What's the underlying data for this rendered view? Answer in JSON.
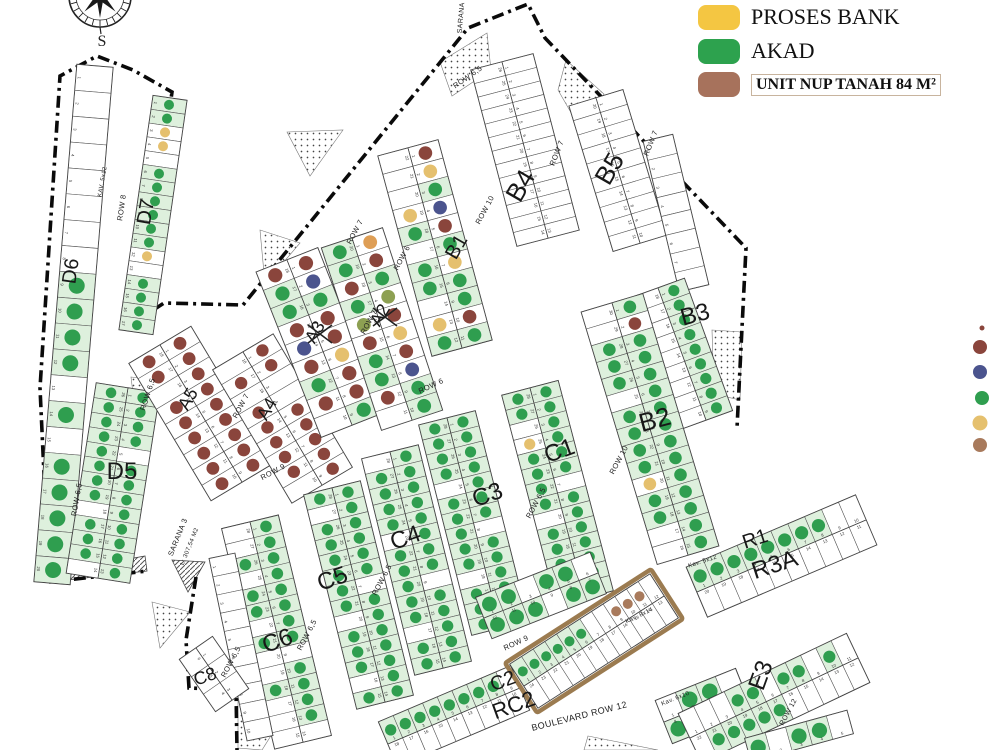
{
  "legend": {
    "items": [
      {
        "label": "PROSES BANK",
        "color": "#f4c642"
      },
      {
        "label": "AKAD",
        "color": "#2da24e"
      },
      {
        "label": "UNIT NUP TANAH 84 M²",
        "color": "#a7725c"
      }
    ]
  },
  "compass": {
    "label": "S"
  },
  "palette": {
    "G": "#2f9e4f",
    "M": "#8a453c",
    "Y": "#e5c06e",
    "N": "#4b548e",
    "B": "#a87a5c",
    "O": "#de9e55",
    "L": "#8da052",
    "tint": "#def0dd",
    "line": "#555555",
    "boundary": "#0a0a0a",
    "nup_outline": "#9b7b50"
  },
  "side_dots": [
    {
      "x": 982,
      "y": 328,
      "r": 2.5,
      "c": "M"
    },
    {
      "x": 980,
      "y": 347,
      "r": 7.0,
      "c": "M"
    },
    {
      "x": 980,
      "y": 372,
      "r": 7.0,
      "c": "N"
    },
    {
      "x": 982,
      "y": 398,
      "r": 7.0,
      "c": "G"
    },
    {
      "x": 980,
      "y": 423,
      "r": 7.5,
      "c": "Y"
    },
    {
      "x": 980,
      "y": 445,
      "r": 7.0,
      "c": "B"
    }
  ],
  "plan": {
    "blocks": [
      {
        "name": "D6",
        "x1": 95,
        "y1": 66,
        "x2": 52,
        "y2": 583,
        "w": 36,
        "rows": 1,
        "n": 20,
        "dots": [
          "--------GGGG-G-GGGGG"
        ]
      },
      {
        "name": "D7",
        "x1": 170,
        "y1": 98,
        "x2": 136,
        "y2": 332,
        "w": 34,
        "rows": 1,
        "n": 17,
        "dots": [
          "GGYY-GGGGGGY-GGGG"
        ]
      },
      {
        "name": "D5",
        "x1": 128,
        "y1": 388,
        "x2": 98,
        "y2": 578,
        "w": 64,
        "rows": 2,
        "n": 13,
        "dots": [
          "GGGG-GGGGGGGG",
          "GGGGGGGG-GGG-"
        ]
      },
      {
        "name": "A5",
        "x1": 160,
        "y1": 345,
        "x2": 242,
        "y2": 482,
        "w": 72,
        "rows": 2,
        "n": 9,
        "dots": [
          "MMMMMMMMM",
          "MM-MMMMMM"
        ]
      },
      {
        "name": "A4",
        "x1": 243,
        "y1": 352,
        "x2": 322,
        "y2": 485,
        "w": 70,
        "rows": 2,
        "n": 9,
        "dots": [
          "MM--MMMMM",
          "-M-MMMMM-"
        ]
      },
      {
        "name": "A3",
        "x1": 287,
        "y1": 260,
        "x2": 352,
        "y2": 425,
        "w": 66,
        "rows": 2,
        "n": 9,
        "dots": [
          "MNGMMYMMG",
          "MGGMNMGM-"
        ]
      },
      {
        "name": "A2",
        "x1": 352,
        "y1": 238,
        "x2": 412,
        "y2": 420,
        "w": 64,
        "rows": 2,
        "n": 10,
        "dots": [
          "OMGLMYMNGG",
          "GGMGLMGGM-"
        ]
      },
      {
        "name": "B1",
        "x1": 408,
        "y1": 148,
        "x2": 462,
        "y2": 348,
        "w": 62,
        "rows": 2,
        "n": 11,
        "dots": [
          "MYGNMGYGGMG",
          "---YG-GG-YG"
        ]
      },
      {
        "name": "B4",
        "x1": 502,
        "y1": 62,
        "x2": 548,
        "y2": 238,
        "w": 64,
        "rows": 2,
        "n": 13,
        "dots": [
          "-------------",
          "-------------"
        ]
      },
      {
        "name": "B5",
        "x1": 596,
        "y1": 98,
        "x2": 640,
        "y2": 243,
        "w": 56,
        "rows": 2,
        "n": 10,
        "dots": [
          "----------",
          "----------"
        ]
      },
      {
        "name": "B5E",
        "x1": 658,
        "y1": 138,
        "x2": 694,
        "y2": 288,
        "w": 30,
        "rows": 1,
        "n": 8,
        "dots": [
          "--------"
        ]
      },
      {
        "name": "B3",
        "x1": 658,
        "y1": 288,
        "x2": 706,
        "y2": 420,
        "w": 56,
        "rows": 2,
        "n": 9,
        "dots": [
          "GGGGGGGGG",
          "---------"
        ]
      },
      {
        "name": "B2",
        "x1": 612,
        "y1": 303,
        "x2": 688,
        "y2": 555,
        "w": 64,
        "rows": 2,
        "n": 15,
        "dots": [
          "GMGGGGGGGGGGGGG",
          "--GGG-GGGGYGG--"
        ]
      },
      {
        "name": "C1",
        "x1": 530,
        "y1": 388,
        "x2": 585,
        "y2": 598,
        "w": 58,
        "rows": 2,
        "n": 14,
        "dots": [
          "GGGGGG-GGGGGGG",
          "GG-YGGGG-GGGGG"
        ]
      },
      {
        "name": "C3",
        "x1": 447,
        "y1": 418,
        "x2": 500,
        "y2": 628,
        "w": 58,
        "rows": 2,
        "n": 14,
        "dots": [
          "GGGGGGG-GGGGGG",
          "GGGG-GGGGG-GGG"
        ]
      },
      {
        "name": "C4",
        "x1": 390,
        "y1": 452,
        "x2": 443,
        "y2": 668,
        "w": 58,
        "rows": 2,
        "n": 14,
        "dots": [
          "GGGGGGGG-GGGGG",
          "-GGGG-GGGGG-GG"
        ]
      },
      {
        "name": "C5",
        "x1": 332,
        "y1": 488,
        "x2": 385,
        "y2": 702,
        "w": 58,
        "rows": 2,
        "n": 14,
        "dots": [
          "GGGGGG-GGGGGGG",
          "G-GGGGGG-GGG-G"
        ]
      },
      {
        "name": "C6",
        "x1": 250,
        "y1": 522,
        "x2": 303,
        "y2": 742,
        "w": 58,
        "rows": 2,
        "n": 14,
        "dots": [
          "GGGGGGGG-GGGG-",
          "--G-GG-G--G---"
        ]
      },
      {
        "name": "C7",
        "x1": 222,
        "y1": 556,
        "x2": 260,
        "y2": 738,
        "w": 26,
        "rows": 1,
        "n": 10,
        "dots": [
          "----------"
        ]
      },
      {
        "name": "C8",
        "x1": 196,
        "y1": 648,
        "x2": 232,
        "y2": 700,
        "w": 40,
        "rows": 2,
        "n": 3,
        "dots": [
          "---",
          "---"
        ]
      },
      {
        "name": "R9M",
        "x1": 484,
        "y1": 618,
        "x2": 598,
        "y2": 573,
        "w": 44,
        "rows": 2,
        "n": 6,
        "dots": [
          "GG-GG-",
          "GGG-GG"
        ]
      },
      {
        "name": "C2S",
        "x1": 388,
        "y1": 744,
        "x2": 520,
        "y2": 688,
        "w": 48,
        "rows": 2,
        "n": 9,
        "dots": [
          "GGGGGGGG-",
          "---------"
        ]
      },
      {
        "name": "RC2N",
        "x1": 524,
        "y1": 686,
        "x2": 664,
        "y2": 596,
        "w": 52,
        "rows": 2,
        "n": 12,
        "dots": [
          "GGGGGG--BBB-",
          "------------"
        ],
        "outline": true
      },
      {
        "name": "K610",
        "x1": 664,
        "y1": 722,
        "x2": 744,
        "y2": 690,
        "w": 46,
        "rows": 2,
        "n": 4,
        "dots": [
          "-GG-",
          "G--G"
        ]
      },
      {
        "name": "E3",
        "x1": 690,
        "y1": 738,
        "x2": 858,
        "y2": 658,
        "w": 54,
        "rows": 2,
        "n": 11,
        "dots": [
          "---GG-GG-G-",
          "-GGGGG-----"
        ]
      },
      {
        "name": "R3A",
        "x1": 697,
        "y1": 592,
        "x2": 866,
        "y2": 520,
        "w": 54,
        "rows": 2,
        "n": 10,
        "dots": [
          "GGGGGGGG--",
          "----------"
        ]
      },
      {
        "name": "E3S",
        "x1": 748,
        "y1": 750,
        "x2": 850,
        "y2": 722,
        "w": 24,
        "rows": 1,
        "n": 5,
        "dots": [
          "G-GG-"
        ]
      }
    ],
    "labels": [
      {
        "t": "D6",
        "x": 77,
        "y": 272,
        "r": -82,
        "s": 20
      },
      {
        "t": "D7",
        "x": 152,
        "y": 213,
        "r": -80,
        "s": 20
      },
      {
        "t": "D5",
        "x": 122,
        "y": 479,
        "r": 0,
        "s": 24
      },
      {
        "t": "A5",
        "x": 193,
        "y": 402,
        "r": -60,
        "s": 18
      },
      {
        "t": "A4",
        "x": 272,
        "y": 412,
        "r": -60,
        "s": 18
      },
      {
        "t": "A3",
        "x": 320,
        "y": 335,
        "r": -60,
        "s": 18,
        "struck": true
      },
      {
        "t": "A2",
        "x": 385,
        "y": 318,
        "r": -60,
        "s": 18,
        "struck": true
      },
      {
        "t": "B1",
        "x": 462,
        "y": 250,
        "r": -60,
        "s": 20
      },
      {
        "t": "B4",
        "x": 528,
        "y": 190,
        "r": -60,
        "s": 26
      },
      {
        "t": "B5",
        "x": 617,
        "y": 173,
        "r": -60,
        "s": 26
      },
      {
        "t": "B3",
        "x": 697,
        "y": 322,
        "r": -15,
        "s": 24
      },
      {
        "t": "B2",
        "x": 657,
        "y": 428,
        "r": -15,
        "s": 26
      },
      {
        "t": "C1",
        "x": 562,
        "y": 458,
        "r": -20,
        "s": 24
      },
      {
        "t": "C3",
        "x": 490,
        "y": 502,
        "r": -20,
        "s": 24
      },
      {
        "t": "C4",
        "x": 408,
        "y": 545,
        "r": -20,
        "s": 24
      },
      {
        "t": "C5",
        "x": 335,
        "y": 586,
        "r": -20,
        "s": 24
      },
      {
        "t": "C6",
        "x": 280,
        "y": 648,
        "r": -20,
        "s": 24
      },
      {
        "t": "C8",
        "x": 207,
        "y": 682,
        "r": -20,
        "s": 18
      },
      {
        "t": "C2",
        "x": 505,
        "y": 687,
        "r": -20,
        "s": 20
      },
      {
        "t": "RC2",
        "x": 516,
        "y": 712,
        "r": -20,
        "s": 22
      },
      {
        "t": "R1",
        "x": 757,
        "y": 545,
        "r": -18,
        "s": 20
      },
      {
        "t": "R3A",
        "x": 777,
        "y": 572,
        "r": -18,
        "s": 24
      },
      {
        "t": "E3",
        "x": 768,
        "y": 678,
        "r": -70,
        "s": 24
      }
    ],
    "streets": [
      {
        "t": "ROW 8",
        "x": 124,
        "y": 208,
        "r": -82
      },
      {
        "t": "KAV. 5x12",
        "x": 104,
        "y": 182,
        "r": -80,
        "s": 6
      },
      {
        "t": "ROW 6,5",
        "x": 150,
        "y": 395,
        "r": -72
      },
      {
        "t": "ROW 6,5",
        "x": 79,
        "y": 500,
        "r": -80
      },
      {
        "t": "ROW 7",
        "x": 243,
        "y": 407,
        "r": -62
      },
      {
        "t": "ROW 7",
        "x": 357,
        "y": 233,
        "r": -62
      },
      {
        "t": "ROW 7",
        "x": 371,
        "y": 323,
        "r": -62
      },
      {
        "t": "ROW 6",
        "x": 404,
        "y": 259,
        "r": -62
      },
      {
        "t": "ROW 6",
        "x": 432,
        "y": 388,
        "r": -25
      },
      {
        "t": "ROW 9",
        "x": 274,
        "y": 474,
        "r": -28
      },
      {
        "t": "ROW 9",
        "x": 517,
        "y": 645,
        "r": -25
      },
      {
        "t": "ROW 10",
        "x": 487,
        "y": 211,
        "r": -62
      },
      {
        "t": "ROW 10",
        "x": 621,
        "y": 461,
        "r": -62
      },
      {
        "t": "ROW 6,5",
        "x": 469,
        "y": 79,
        "r": -35
      },
      {
        "t": "ROW 7",
        "x": 559,
        "y": 154,
        "r": -68
      },
      {
        "t": "ROW 7",
        "x": 653,
        "y": 144,
        "r": -68
      },
      {
        "t": "ROW 6,5",
        "x": 309,
        "y": 636,
        "r": -62
      },
      {
        "t": "ROW 6,5",
        "x": 384,
        "y": 581,
        "r": -62
      },
      {
        "t": "ROW 6,5",
        "x": 233,
        "y": 663,
        "r": -62
      },
      {
        "t": "ROW 6,5",
        "x": 538,
        "y": 504,
        "r": -62
      },
      {
        "t": "BOULEVARD ROW 12",
        "x": 580,
        "y": 719,
        "r": -14,
        "s": 9
      },
      {
        "t": "SARANA 3",
        "x": 180,
        "y": 538,
        "r": -68
      },
      {
        "t": "L: 307,54 M2",
        "x": 191,
        "y": 547,
        "r": -68,
        "s": 6
      },
      {
        "t": "SARANA",
        "x": 463,
        "y": 18,
        "r": -85,
        "s": 7
      },
      {
        "t": "Kav. 5x12",
        "x": 703,
        "y": 563,
        "r": -18,
        "s": 6
      },
      {
        "t": "Kav. 6x10",
        "x": 676,
        "y": 700,
        "r": -22,
        "s": 6
      },
      {
        "t": "Kav. 8x14",
        "x": 640,
        "y": 617,
        "r": -26,
        "s": 6
      },
      {
        "t": "ROW 12",
        "x": 790,
        "y": 713,
        "r": -62,
        "s": 7
      }
    ],
    "boundaries": [
      [
        [
          49,
          582
        ],
        [
          40,
          388
        ],
        [
          60,
          76
        ],
        [
          97,
          56
        ],
        [
          133,
          70
        ],
        [
          172,
          92
        ],
        [
          141,
          318
        ],
        [
          164,
          303
        ],
        [
          243,
          305
        ],
        [
          468,
          28
        ],
        [
          528,
          4
        ],
        [
          545,
          38
        ],
        [
          746,
          248
        ],
        [
          737,
          428
        ]
      ],
      [
        [
          49,
          582
        ],
        [
          147,
          571
        ]
      ],
      [
        [
          196,
          577
        ],
        [
          186,
          640
        ],
        [
          189,
          688
        ],
        [
          236,
          690
        ],
        [
          237,
          750
        ]
      ]
    ],
    "stipples": [
      [
        [
          260,
          230
        ],
        [
          300,
          243
        ],
        [
          265,
          284
        ]
      ],
      [
        [
          131,
          377
        ],
        [
          156,
          380
        ],
        [
          136,
          418
        ]
      ],
      [
        [
          440,
          62
        ],
        [
          487,
          33
        ],
        [
          491,
          70
        ],
        [
          452,
          96
        ]
      ],
      [
        [
          566,
          60
        ],
        [
          604,
          94
        ],
        [
          581,
          130
        ],
        [
          558,
          90
        ]
      ],
      [
        [
          712,
          330
        ],
        [
          742,
          332
        ],
        [
          740,
          400
        ],
        [
          714,
          394
        ]
      ],
      [
        [
          238,
          694
        ],
        [
          292,
          702
        ],
        [
          262,
          750
        ],
        [
          238,
          748
        ]
      ],
      [
        [
          588,
          736
        ],
        [
          658,
          750
        ],
        [
          584,
          750
        ]
      ],
      [
        [
          152,
          602
        ],
        [
          190,
          612
        ],
        [
          160,
          648
        ]
      ],
      [
        [
          287,
          132
        ],
        [
          343,
          130
        ],
        [
          310,
          176
        ]
      ]
    ],
    "hatches": [
      [
        [
          58,
          572
        ],
        [
          145,
          556
        ],
        [
          147,
          571
        ],
        [
          50,
          582
        ]
      ],
      [
        [
          172,
          560
        ],
        [
          205,
          562
        ],
        [
          188,
          592
        ]
      ]
    ]
  }
}
